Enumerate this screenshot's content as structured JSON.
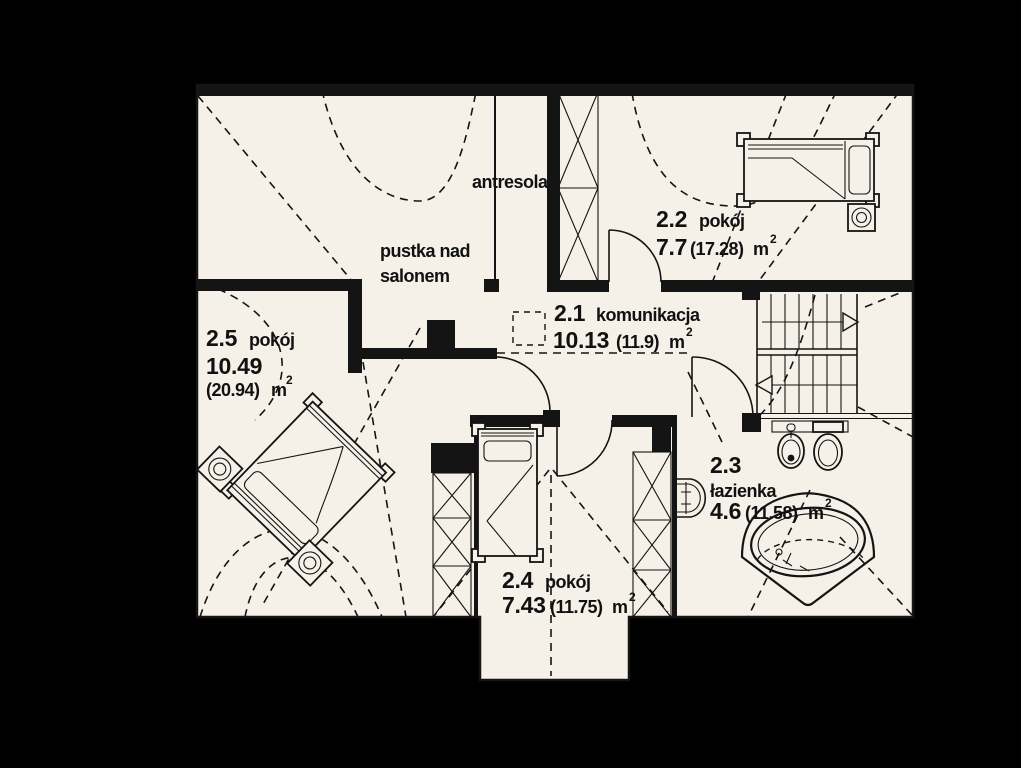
{
  "colors": {
    "background": "#000000",
    "floor": "#f6f1e8",
    "line": "#141414"
  },
  "labels": {
    "antresola": "antresola",
    "pustka_line1": "pustka nad",
    "pustka_line2": "salonem",
    "unit": "m",
    "sup": "2"
  },
  "rooms": {
    "komunikacja": {
      "number": "2.1",
      "name": "komunikacja",
      "area": "10.13",
      "area_total": "(11.9)"
    },
    "pokoj_2_2": {
      "number": "2.2",
      "name": "pokój",
      "area": "7.7",
      "area_total": "(17.28)"
    },
    "lazienka": {
      "number": "2.3",
      "name": "łazienka",
      "area": "4.6",
      "area_total": "(11.58)"
    },
    "pokoj_2_4": {
      "number": "2.4",
      "name": "pokój",
      "area": "7.43",
      "area_total": "(11.75)"
    },
    "pokoj_2_5": {
      "number": "2.5",
      "name": "pokój",
      "area": "10.49",
      "area_total": "(20.94)"
    }
  }
}
